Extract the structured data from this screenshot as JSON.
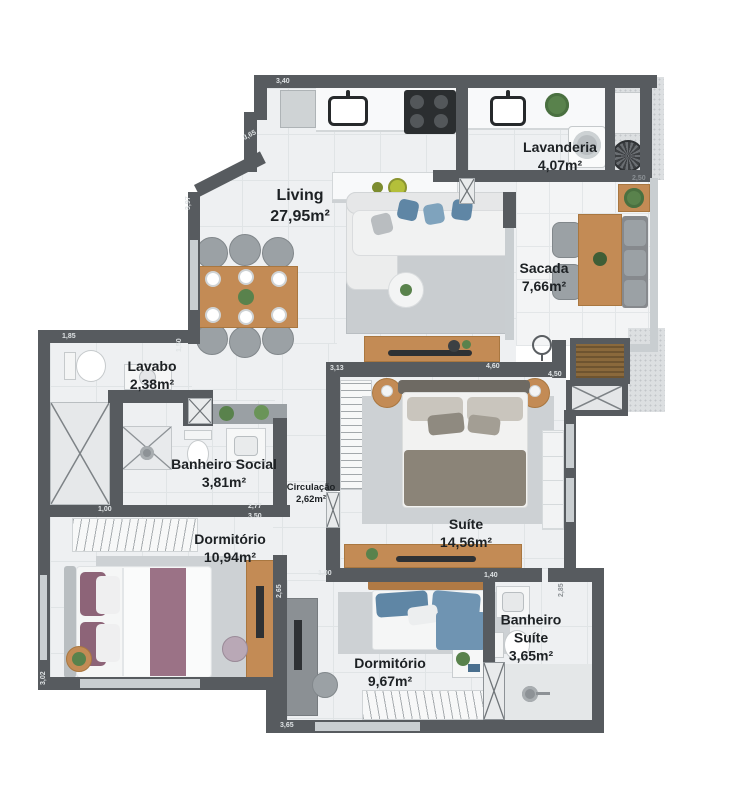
{
  "plan_title": "apartment-floor-plan",
  "rooms": [
    {
      "name": "Living",
      "area": "27,95m²"
    },
    {
      "name": "Lavanderia",
      "area": "4,07m²"
    },
    {
      "name": "Sacada",
      "area": "7,66m²"
    },
    {
      "name": "Lavabo",
      "area": "2,38m²"
    },
    {
      "name": "Banheiro Social",
      "area": "3,81m²"
    },
    {
      "name": "Circulação",
      "area": "2,62m²"
    },
    {
      "name": "Suíte",
      "area": "14,56m²"
    },
    {
      "name": "Dormitório",
      "area": "10,94m²"
    },
    {
      "name": "Dormitório",
      "area": "9,67m²"
    },
    {
      "name": "Banheiro Suíte",
      "area": "3,65m²",
      "name_line1": "Banheiro",
      "name_line2": "Suíte"
    }
  ],
  "dimensions": [
    {
      "label": "3,40"
    },
    {
      "label": "3,65"
    },
    {
      "label": "3,97"
    },
    {
      "label": "1,85"
    },
    {
      "label": "1,50"
    },
    {
      "label": "2,50"
    },
    {
      "label": "3,13"
    },
    {
      "label": "4,60"
    },
    {
      "label": "4,50"
    },
    {
      "label": "2,77"
    },
    {
      "label": "3,50"
    },
    {
      "label": "1,00"
    },
    {
      "label": "1,00"
    },
    {
      "label": "2,65"
    },
    {
      "label": "3,02"
    },
    {
      "label": "3,65"
    },
    {
      "label": "1,40"
    },
    {
      "label": "2,85"
    }
  ],
  "colors": {
    "wall": "#575b5f",
    "floor": "#eef0f2",
    "wood": "#c38b55",
    "rug": "#cdd1d4",
    "accent_blue": "#5f86a5",
    "accent_purple": "#8d6478",
    "plant_green": "#59824c"
  }
}
